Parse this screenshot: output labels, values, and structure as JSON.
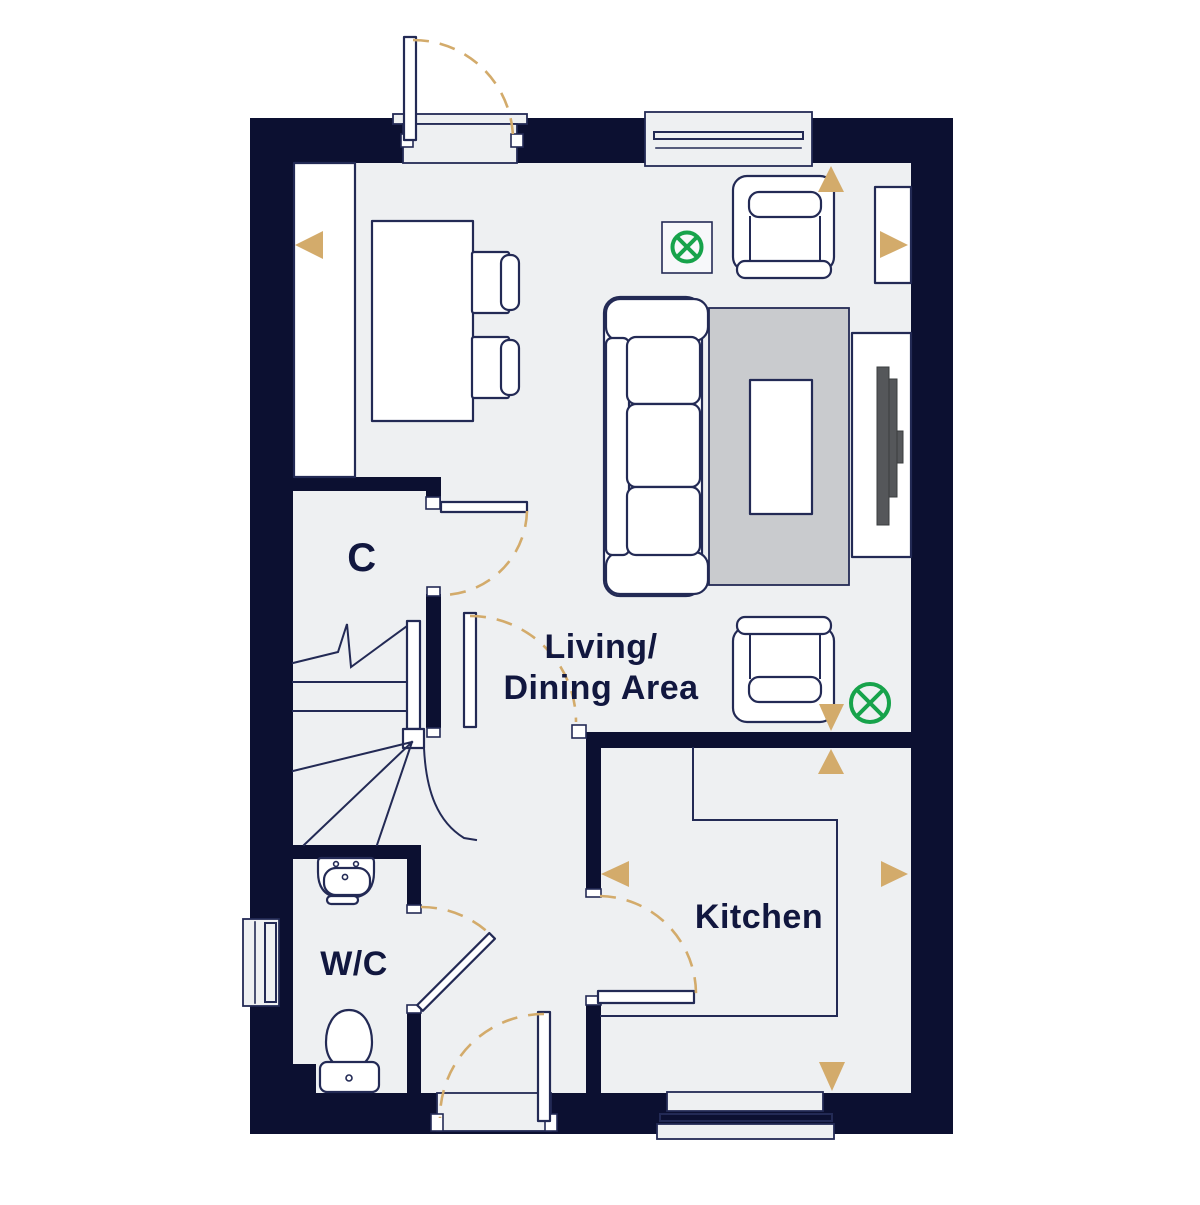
{
  "labels": {
    "cupboard": "C",
    "living_dining_line1": "Living/",
    "living_dining_line2": "Dining Area",
    "kitchen": "Kitchen",
    "wc": "W/C"
  },
  "colors": {
    "wall": "#0c1031",
    "floor": "#eef0f2",
    "outline": "#232a55",
    "white": "#ffffff",
    "rug": "#c9cbce",
    "tan": "#d3ab6b",
    "green": "#17a34b",
    "tv": "#55575a",
    "text": "#11173f",
    "background": "#ffffff"
  },
  "icons": {
    "ceiling_light": "circled-cross",
    "dimension_marker": "triangle",
    "door_swing": "dashed-arc"
  }
}
